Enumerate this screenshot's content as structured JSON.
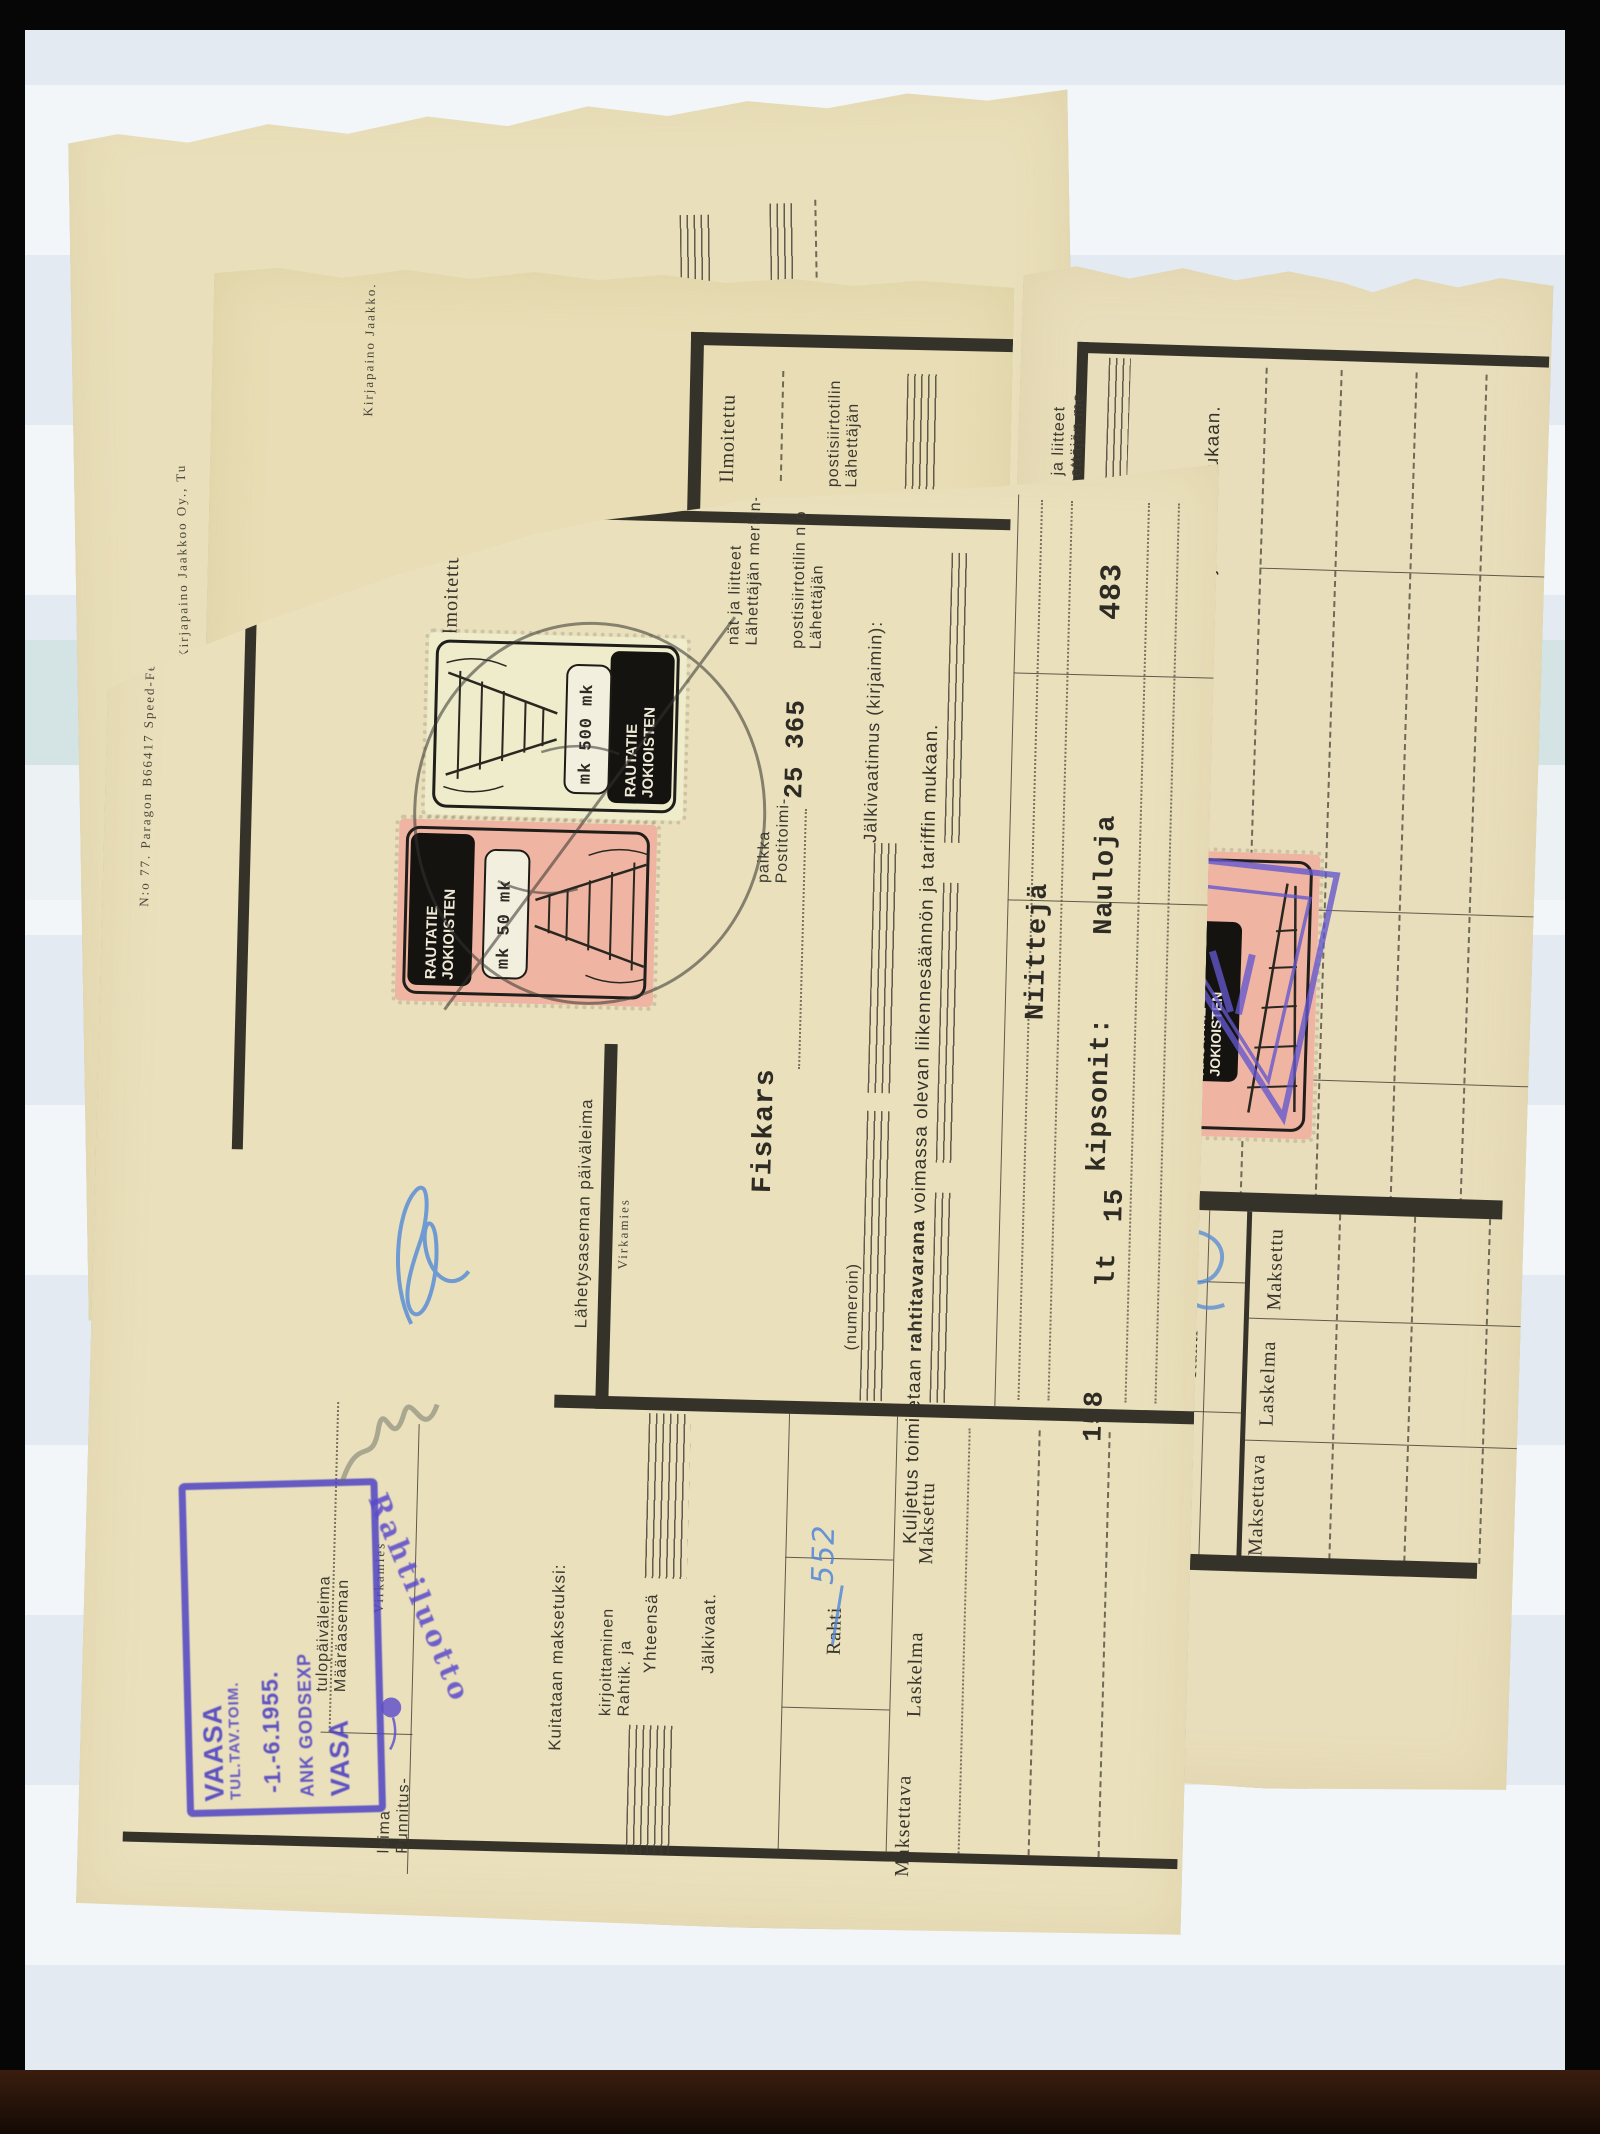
{
  "docA": {
    "kirjapaino": "Kirjapaino Jaakkoo Oy., Tu",
    "ilmoitettu_box": "ilmoitettu (milloin ja",
    "lahettaja_post": [
      "Lähettä-",
      "postisii"
    ],
    "lahettaja_merk": [
      "Lähettä-",
      "nät ja"
    ],
    "kuljetus": "Kuljetus",
    "jalkivaa": "Jälkivaa"
  },
  "docB": {
    "kirjapaino": "Kirjapaino Jaakko.",
    "ilmoitettu": "Ilmoitettu",
    "post": [
      "Lähettäjän",
      "postisiirtotilin"
    ]
  },
  "docD": {
    "post2": [
      "Lähettäjän me",
      "nät ja liitteet"
    ],
    "jalkivaatimus": "Jälkivaatimus (kirjaimin):",
    "kuljetus": {
      "pre": "Kuljetus toimitetaan ",
      "bold": "rahtitavarana",
      "post": " voimassa olevan liikennesäännön ja tariffin mukaan."
    },
    "stamp": {
      "line1": "JOKIOISTEN",
      "line2": "RAUTATIE"
    },
    "table": {
      "maksettu": "Maksettu",
      "laskelma": "Laskelma",
      "maksettava": "Maksettava",
      "rahti": "Rahti"
    }
  },
  "docC": {
    "imprint": "N:o 77. Paragon B66417 Speed-Feed",
    "ilmoitettu": "Ilmoitettu",
    "virkamies": "Virkamies",
    "stamp500": {
      "line1": "JOKIOISTEN",
      "line2": "RAUTATIE",
      "value": "mk 500 mk"
    },
    "stamp50": {
      "line1": "JOKIOISTEN",
      "line2": "RAUTATIE",
      "value": "mk 50 mk"
    },
    "merkinnat": [
      "Lähettäjän merkin-",
      "nät ja liitteet"
    ],
    "postisiirto": [
      "Lähettäjän",
      "postisiirtotilin n:o"
    ],
    "account_no": "25 365",
    "postitoimi": [
      "Postitoimi-",
      "paikka"
    ],
    "office": "Fiskars",
    "jalkivaatimus": "Jälkivaatimus (kirjaimin):",
    "kuljetus": {
      "pre": "Kuljetus toimitetaan ",
      "bold": "rahtitavarana",
      "post": " voimassa olevan liikennesäännön ja tariffin mukaan."
    },
    "numeroin": "(numeroin)",
    "waybill_no": "483",
    "goods_line1": "Nauloja",
    "goods_line2": "kipsonit:",
    "goods_line3": "Niittejä",
    "qty": "15",
    "unit": "lt",
    "weight": "158",
    "lahetysasema": "Lähetysaseman päiväleima",
    "maaraasema": [
      "Määräaseman",
      "tulopäiväleima"
    ],
    "punnitus": [
      "Punnitus-",
      "leima"
    ],
    "table": {
      "maksettu": "Maksettu",
      "rahti": "Rahti",
      "laskelma": "Laskelma",
      "maksettava": "Maksettava",
      "jalkivaat": "Jälkivaat.",
      "yhteensa": "Yhteensä",
      "rahtik": [
        "Rahtik. ja",
        "kirjoittaminen"
      ],
      "kuitataan": "Kuitataan maksetuksi:"
    },
    "handwriting": {
      "amount": "552"
    },
    "arrival_stamp": {
      "l1": "VAASA",
      "l2": "TUL.TAV.TOIM.",
      "l3": "-1.-6.1955.",
      "l4": "ANK GODSEXP",
      "l5": "VASA"
    },
    "credit_stamp": "Rahtiluotto"
  },
  "colors": {
    "paper": "#e9dfba",
    "page": "#e3eaf1",
    "violet": "#4f43c4",
    "stamp_pink": "#f0b5a2",
    "stamp_cream": "#eeeccb"
  }
}
